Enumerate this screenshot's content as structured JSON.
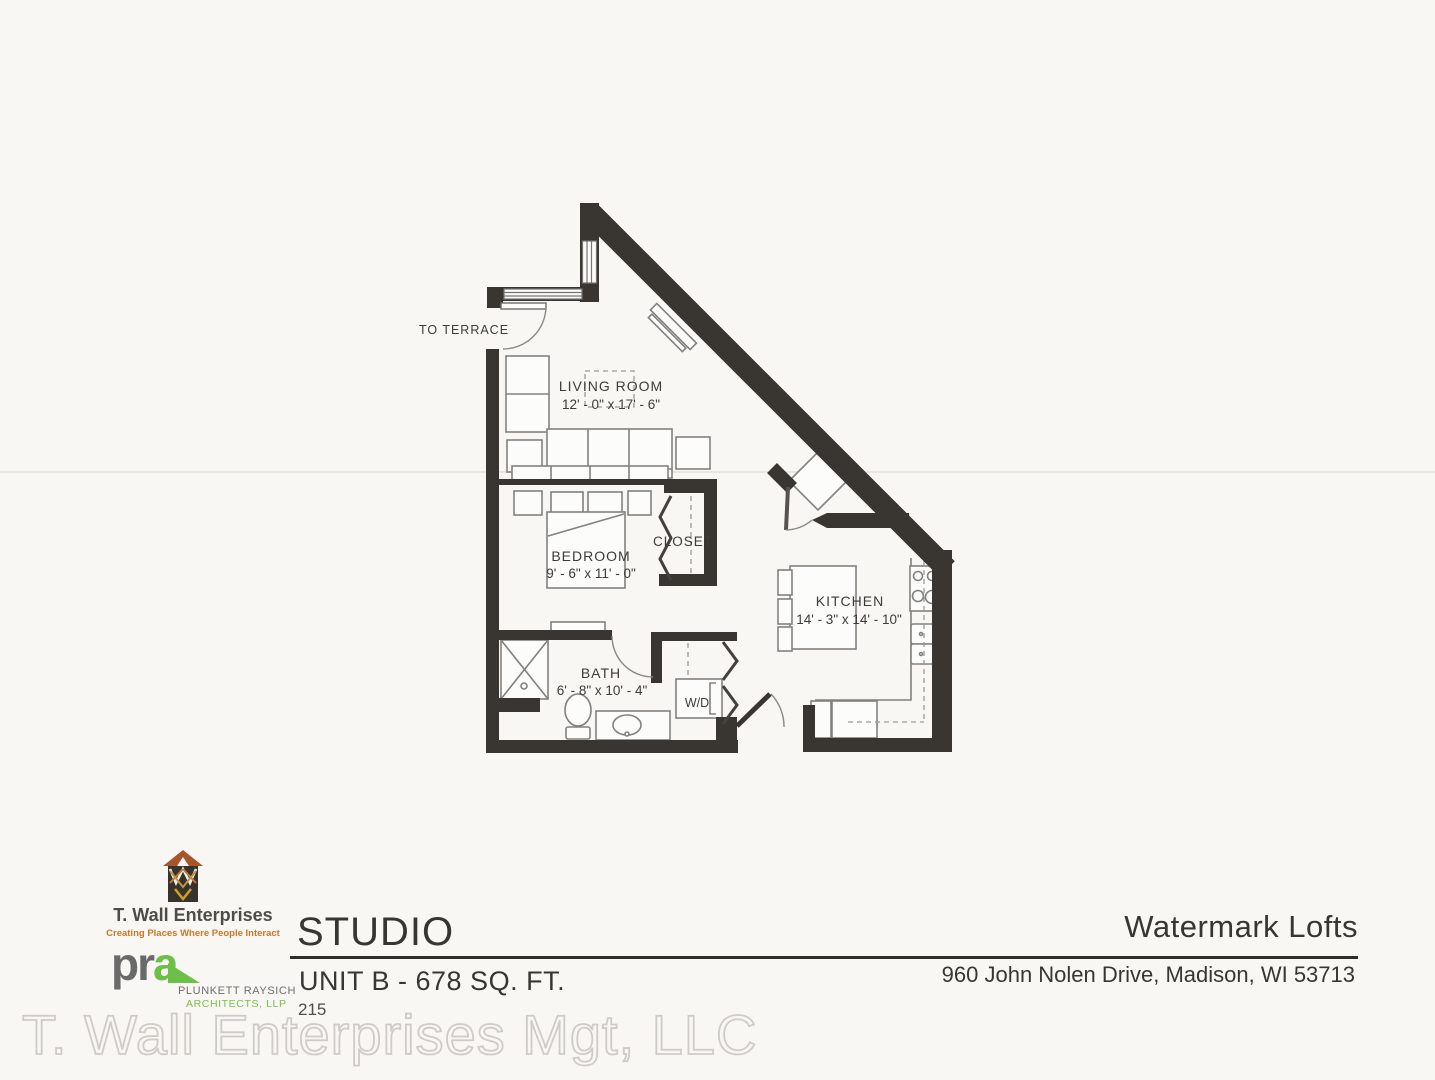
{
  "plan": {
    "terrace_label": "TO TERRACE",
    "rooms": [
      {
        "name": "LIVING ROOM",
        "dims": "12' - 0\" x 17' - 6\""
      },
      {
        "name": "BEDROOM",
        "dims": "9' - 6\" x 11' - 0\""
      },
      {
        "name": "CLOSET",
        "dims": ""
      },
      {
        "name": "KITCHEN",
        "dims": "14' - 3\" x 14' - 10\""
      },
      {
        "name": "BATH",
        "dims": "6' - 8\" x 10' - 4\""
      },
      {
        "name": "W/D",
        "dims": ""
      }
    ],
    "colors": {
      "wall": "#393531",
      "furniture_outline": "#83817d"
    }
  },
  "title_block": {
    "unit_type": "STUDIO",
    "unit_info": "UNIT B - 678 SQ. FT.",
    "unit_number": "215",
    "property_name": "Watermark Lofts",
    "property_address": "960 John Nolen Drive, Madison, WI 53713"
  },
  "branding": {
    "twall": {
      "name": "T. Wall Enterprises",
      "tagline": "Creating Places Where People Interact",
      "accent_orange": "#cf7527"
    },
    "pra": {
      "logo_pr": "pr",
      "logo_a": "a",
      "name_line1": "PLUNKETT RAYSICH",
      "name_line2": "ARCHITECTS, LLP",
      "brand_green": "#6cc047",
      "brand_gray": "#6a6a6a"
    }
  },
  "watermark_text": "T. Wall Enterprises Mgt, LLC"
}
